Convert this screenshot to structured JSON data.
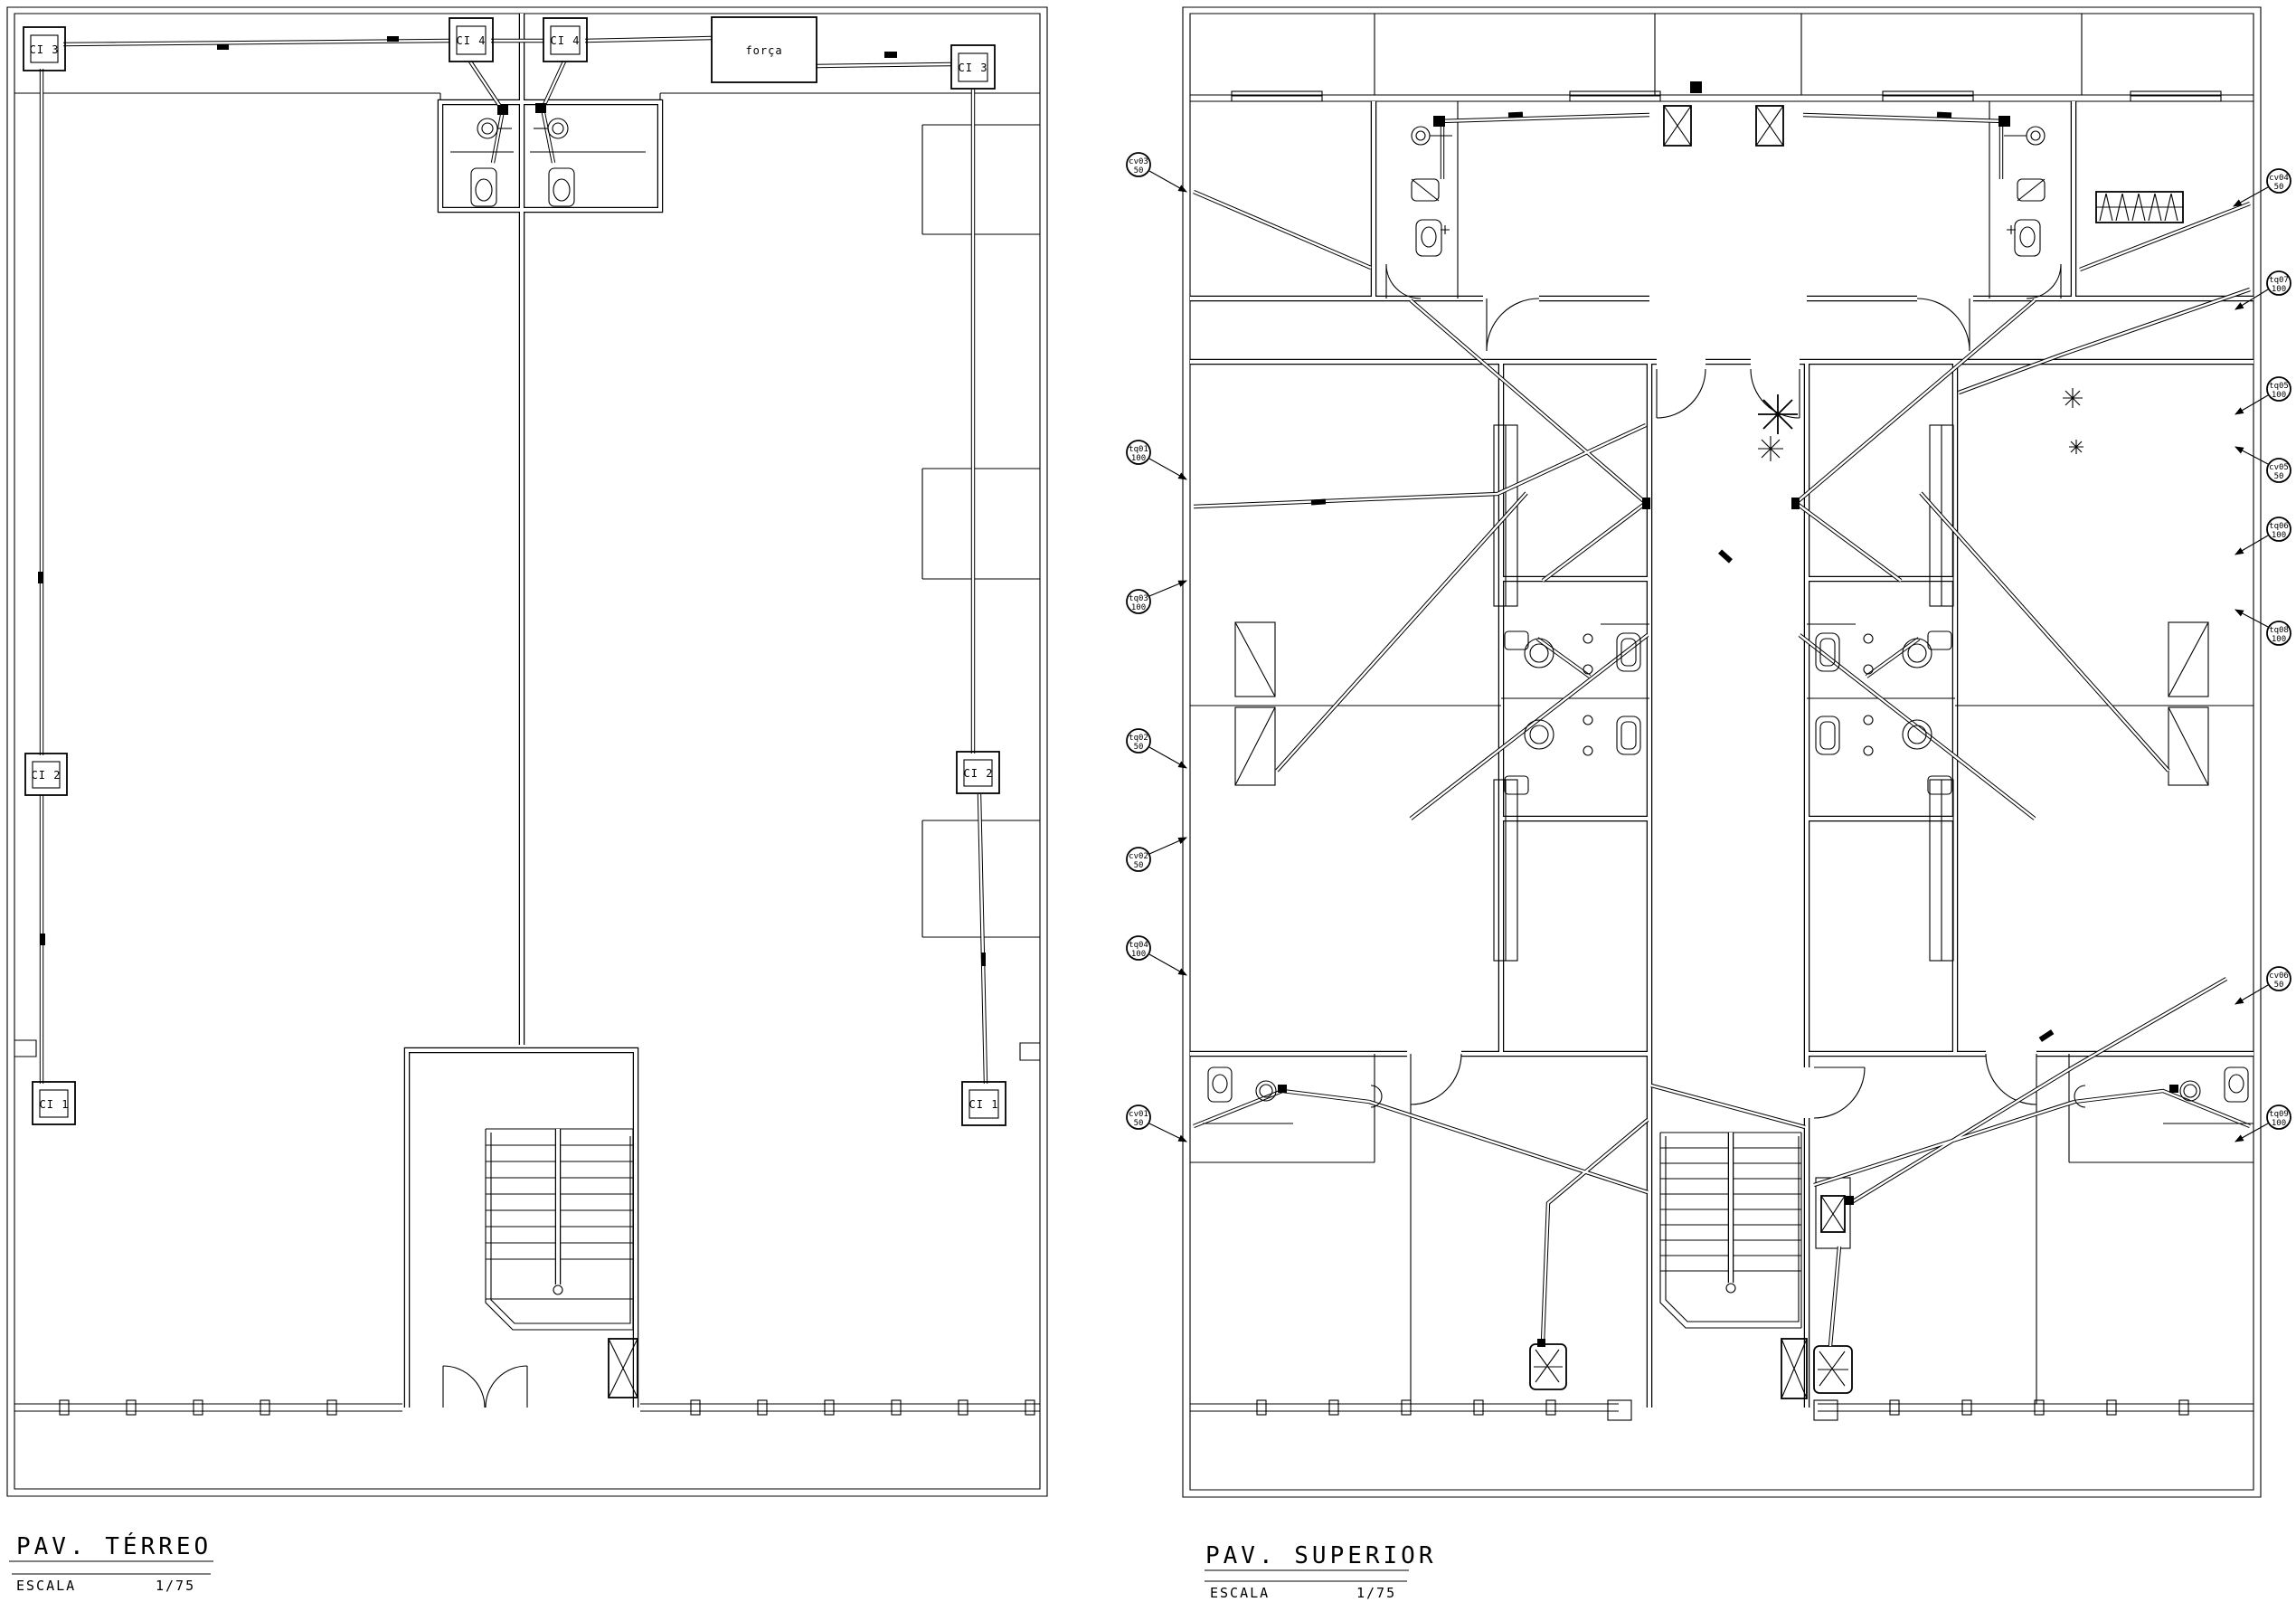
{
  "drawing": {
    "paper_color": "#ffffff",
    "ink_color": "#000000"
  },
  "terreo": {
    "title": "PAV. TÉRREO",
    "scale_label": "ESCALA",
    "scale_value": "1/75",
    "forca_label": "força",
    "boxes": {
      "ci3_top_left": "CI 3",
      "ci4_left": "CI 4",
      "ci4_right": "CI 4",
      "ci3_top_right": "CI 3",
      "ci2_left": "CI 2",
      "ci2_right": "CI 2",
      "ci1_left": "CI 1",
      "ci1_right": "CI 1"
    }
  },
  "superior": {
    "title": "PAV. SUPERIOR",
    "scale_label": "ESCALA",
    "scale_value": "1/75",
    "callouts_left": [
      {
        "label": "cv03",
        "dia": "50"
      },
      {
        "label": "tq01",
        "dia": "100"
      },
      {
        "label": "tq03",
        "dia": "100"
      },
      {
        "label": "tq02",
        "dia": "50"
      },
      {
        "label": "cv02",
        "dia": "50"
      },
      {
        "label": "tq04",
        "dia": "100"
      },
      {
        "label": "cv01",
        "dia": "50"
      }
    ],
    "callouts_right": [
      {
        "label": "cv04",
        "dia": "50"
      },
      {
        "label": "tq07",
        "dia": "100"
      },
      {
        "label": "tq05",
        "dia": "100"
      },
      {
        "label": "cv05",
        "dia": "50"
      },
      {
        "label": "tq06",
        "dia": "100"
      },
      {
        "label": "tq08",
        "dia": "100"
      },
      {
        "label": "cv06",
        "dia": "50"
      },
      {
        "label": "tq09",
        "dia": "100"
      }
    ]
  }
}
